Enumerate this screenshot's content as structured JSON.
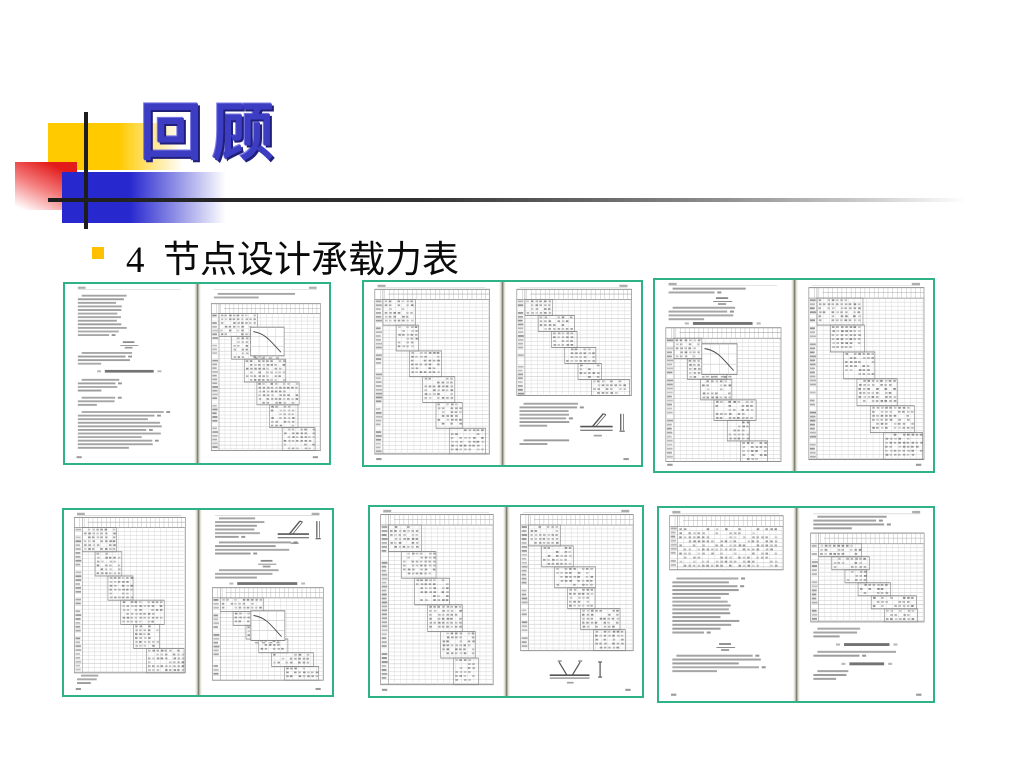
{
  "slide": {
    "title": "回顾",
    "bullet_text": "4  节点设计承载力表",
    "colors": {
      "title_blue": "#3d3dc4",
      "title_shadow": "#20207a",
      "bullet_yellow": "#ffc000",
      "deco_yellow": "#ffca00",
      "deco_red": "#e31b1b",
      "deco_blue": "#2828cf",
      "deco_line": "#1d1d1d",
      "thumbnail_border": "#2fb287",
      "page_ink": "#8a8a8a"
    }
  },
  "thumbnails": [
    {
      "name": "spread-1",
      "description": "Scanned spread: formulas and notation notes (left); stepped joint design capacity table with inset curve chart (right)",
      "geometry": {
        "left": 63,
        "top": 282,
        "width": 268,
        "height": 183
      },
      "pages": [
        {
          "side": "L",
          "blocks": [
            {
              "t": "lines",
              "y": 6,
              "n": 12,
              "w": 0.5
            },
            {
              "t": "formula",
              "y": 32
            },
            {
              "t": "lines",
              "y": 38,
              "n": 4,
              "w": 0.52
            },
            {
              "t": "heading",
              "y": 48,
              "w": 38
            },
            {
              "t": "lines",
              "y": 53,
              "n": 4,
              "w": 0.42
            },
            {
              "t": "lines",
              "y": 63,
              "n": 3,
              "w": 0.38
            },
            {
              "t": "lines",
              "y": 71,
              "n": 11,
              "w": 0.82
            }
          ]
        },
        {
          "side": "R",
          "blocks": [
            {
              "t": "lines",
              "y": 5,
              "n": 2,
              "w": 0.88
            },
            {
              "t": "table",
              "y": 11,
              "h": 82,
              "stair": true,
              "graph": {
                "gx": 0.52,
                "gy": 0.16
              }
            }
          ]
        }
      ]
    },
    {
      "name": "spread-2",
      "description": "Scanned spread: full-page stepped capacity table (left); capacity table, notes and tube joint sketch (right)",
      "geometry": {
        "left": 362,
        "top": 280,
        "width": 281,
        "height": 187
      },
      "pages": [
        {
          "side": "L",
          "blocks": [
            {
              "t": "table",
              "y": 4,
              "h": 90,
              "stair": true,
              "dense": true
            }
          ]
        },
        {
          "side": "R",
          "blocks": [
            {
              "t": "table",
              "y": 4,
              "h": 58,
              "stair": true,
              "dense": true
            },
            {
              "t": "lines",
              "y": 66,
              "n": 7,
              "w": 0.55
            },
            {
              "t": "diagram",
              "y": 70,
              "x": 55,
              "variant": "joint"
            },
            {
              "t": "lines",
              "y": 86,
              "n": 2,
              "w": 0.45
            }
          ]
        }
      ]
    },
    {
      "name": "spread-3",
      "description": "Scanned spread: notes, formula and stepped table with inset curve chart (left); full-page capacity table (right)",
      "geometry": {
        "left": 653,
        "top": 278,
        "width": 282,
        "height": 195
      },
      "pages": [
        {
          "side": "L",
          "blocks": [
            {
              "t": "lines",
              "y": 4,
              "n": 2,
              "w": 0.75
            },
            {
              "t": "formula",
              "y": 9
            },
            {
              "t": "lines",
              "y": 14,
              "n": 4,
              "w": 0.68
            },
            {
              "t": "heading",
              "y": 22,
              "w": 44
            },
            {
              "t": "table",
              "y": 25,
              "h": 70,
              "stair": true,
              "graph": {
                "gx": 0.45,
                "gy": 0.12
              }
            }
          ]
        },
        {
          "side": "R",
          "blocks": [
            {
              "t": "table",
              "y": 4,
              "h": 90,
              "stair": true,
              "dense": true
            }
          ]
        }
      ]
    },
    {
      "name": "spread-4",
      "description": "Scanned spread: full-page stepped capacity table (left); notes with joint sketch, formula and table with curve chart (right)",
      "geometry": {
        "left": 62,
        "top": 508,
        "width": 272,
        "height": 189
      },
      "pages": [
        {
          "side": "L",
          "blocks": [
            {
              "t": "table",
              "y": 4,
              "h": 84,
              "stair": true,
              "dense": true
            },
            {
              "t": "lines",
              "y": 89,
              "n": 3,
              "w": 0.22
            }
          ]
        },
        {
          "side": "R",
          "blocks": [
            {
              "t": "lines",
              "y": 4,
              "n": 6,
              "w": 0.48
            },
            {
              "t": "diagram",
              "y": 4,
              "x": 58,
              "variant": "joint"
            },
            {
              "t": "lines",
              "y": 17,
              "n": 4,
              "w": 0.72
            },
            {
              "t": "formula",
              "y": 27
            },
            {
              "t": "lines",
              "y": 32,
              "n": 3,
              "w": 0.75
            },
            {
              "t": "heading",
              "y": 39,
              "w": 46
            },
            {
              "t": "table",
              "y": 42,
              "h": 50,
              "stair": true,
              "graph": {
                "gx": 0.5,
                "gy": 0.25
              }
            }
          ]
        }
      ]
    },
    {
      "name": "spread-5",
      "description": "Scanned spread: full-page stepped capacity table (left); capacity table with K-joint sketch below (right)",
      "geometry": {
        "left": 368,
        "top": 505,
        "width": 276,
        "height": 193
      },
      "pages": [
        {
          "side": "L",
          "blocks": [
            {
              "t": "table",
              "y": 4,
              "h": 90,
              "stair": true,
              "dense": true
            }
          ]
        },
        {
          "side": "R",
          "blocks": [
            {
              "t": "table",
              "y": 4,
              "h": 72,
              "stair": true,
              "dense": true
            },
            {
              "t": "diagram",
              "y": 80,
              "x": 30,
              "variant": "kjoint"
            }
          ]
        }
      ]
    },
    {
      "name": "spread-6",
      "description": "Scanned spread: small table above notation notes (left); notes, capacity table and section headings (right)",
      "geometry": {
        "left": 657,
        "top": 506,
        "width": 278,
        "height": 197
      },
      "pages": [
        {
          "side": "L",
          "blocks": [
            {
              "t": "table",
              "y": 4,
              "h": 28,
              "stair": false,
              "dense": true
            },
            {
              "t": "lines",
              "y": 36,
              "n": 15,
              "w": 0.62
            },
            {
              "t": "formula",
              "y": 70
            },
            {
              "t": "lines",
              "y": 76,
              "n": 5,
              "w": 0.82
            }
          ]
        },
        {
          "side": "R",
          "blocks": [
            {
              "t": "lines",
              "y": 4,
              "n": 4,
              "w": 0.78
            },
            {
              "t": "table",
              "y": 13,
              "h": 46,
              "stair": true,
              "dense": true
            },
            {
              "t": "lines",
              "y": 62,
              "n": 3,
              "w": 0.45
            },
            {
              "t": "heading",
              "y": 70,
              "w": 34
            },
            {
              "t": "lines",
              "y": 74,
              "n": 2,
              "w": 0.78
            },
            {
              "t": "heading",
              "y": 80,
              "w": 26
            },
            {
              "t": "lines",
              "y": 84,
              "n": 3,
              "w": 0.35
            }
          ]
        }
      ]
    }
  ]
}
